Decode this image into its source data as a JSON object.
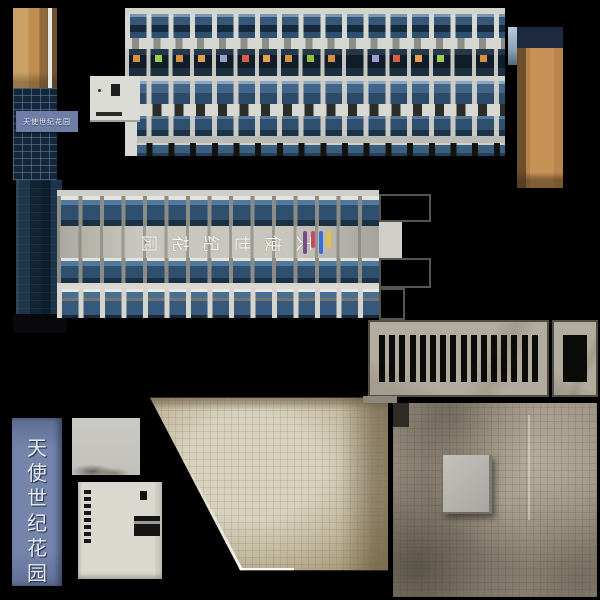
{
  "background": "#000000",
  "palette": {
    "glass_dark": "#16263a",
    "glass_blue": "#2e4f6e",
    "glass_light": "#4a708e",
    "concrete_light": "#d8d8d2",
    "concrete_mid": "#b3b1a8",
    "tan_wall": "#c08b4f",
    "tan_shadow": "#6b4f2e",
    "navy_cap": "#1d2940",
    "sign_blue": "#6e7ea6",
    "grill_frame": "#b2ac9f",
    "ground_beige": "#c8c1ad",
    "ground_brown": "#988e80",
    "cream_panel": "#dbd8cf"
  },
  "tower": {
    "sign_text": "天使世纪花园"
  },
  "vertical_sign": {
    "text": "天使世纪花园",
    "chars": [
      "天",
      "使",
      "世",
      "纪",
      "花",
      "园"
    ],
    "text_color": "#e6eaf0",
    "bg": "#6e7ea6"
  },
  "facade_band": {
    "chars": [
      "园",
      "花",
      "纪",
      "世",
      "使",
      "天"
    ],
    "char_color": "#f5f5f0",
    "logo_colors": [
      "#7a4a8a",
      "#c94a5a",
      "#3a6fd9",
      "#e8c040"
    ]
  },
  "top_facade": {
    "accent_colors": [
      "#d6913f",
      "#9ccf4a",
      "#d6913f",
      "#e0a048",
      "#98a0cc",
      "#d45f43",
      "#e8a04f",
      "#d6913f",
      "#8fbf3f",
      "#d98f3a",
      "none",
      "#98a0cc",
      "#d45f43",
      "#e8a04f",
      "#9ccf4a",
      "none",
      "#d6913f"
    ]
  },
  "grills": {
    "wide_slots": 16,
    "narrow_slots": 4
  },
  "cream_panel": {
    "dash_count": 8
  }
}
